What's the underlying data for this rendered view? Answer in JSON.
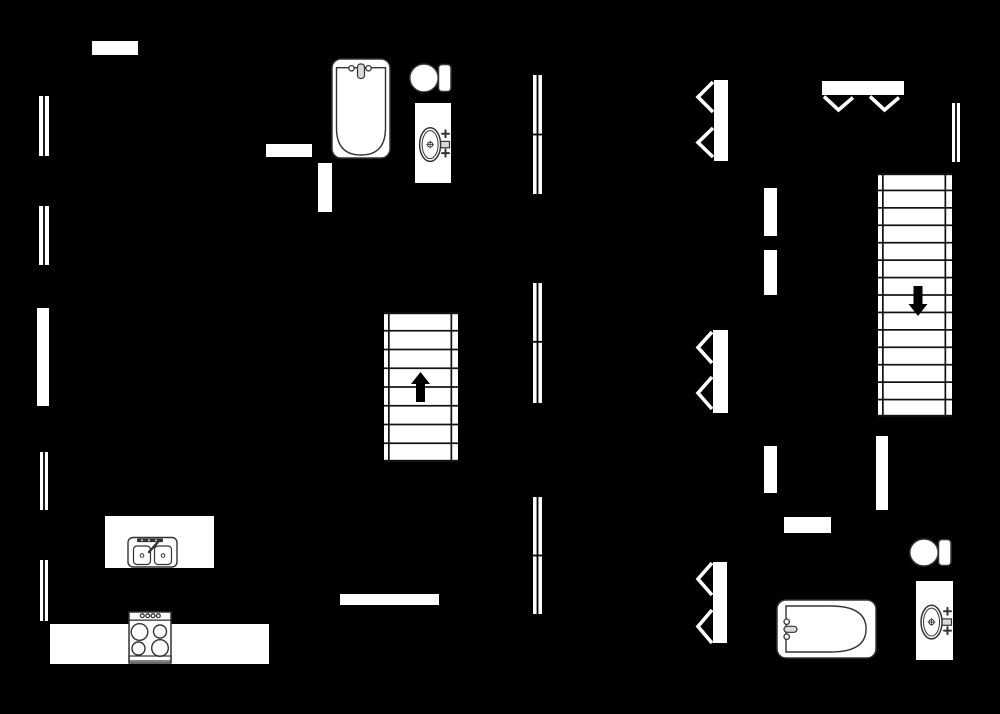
{
  "meta": {
    "diagram_type": "floor-plan",
    "canvas": {
      "width": 1000,
      "height": 714
    },
    "colors": {
      "background": "#000000",
      "walls": "#ffffff",
      "fixture_outline": "#333333",
      "fixture_metal": "#d9d9d9",
      "stair_lines": "#111111",
      "arrow": "#000000"
    }
  },
  "elements": [
    {
      "t": "wall",
      "name": "wall-top-left",
      "x": 92,
      "y": 41,
      "w": 46,
      "h": 14
    },
    {
      "t": "wall",
      "name": "wall-left-middle",
      "x": 37,
      "y": 308,
      "w": 12,
      "h": 98
    },
    {
      "t": "wall",
      "name": "wall-kitchen-horizontal",
      "x": 266,
      "y": 144,
      "w": 46,
      "h": 13
    },
    {
      "t": "wall",
      "name": "wall-kitchen-vertical",
      "x": 318,
      "y": 163,
      "w": 14,
      "h": 49
    },
    {
      "t": "wall",
      "name": "wall-hall-upper-a",
      "x": 764,
      "y": 188,
      "w": 13,
      "h": 48
    },
    {
      "t": "wall",
      "name": "wall-hall-upper-b",
      "x": 764,
      "y": 250,
      "w": 13,
      "h": 45
    },
    {
      "t": "wall",
      "name": "wall-hall-lower",
      "x": 764,
      "y": 446,
      "w": 13,
      "h": 47
    },
    {
      "t": "wall",
      "name": "wall-stair-lower",
      "x": 876,
      "y": 436,
      "w": 12,
      "h": 74
    },
    {
      "t": "wall",
      "name": "wall-bath-lower",
      "x": 784,
      "y": 517,
      "w": 47,
      "h": 16
    },
    {
      "t": "wall",
      "name": "wall-bottom-middle",
      "x": 340,
      "y": 594,
      "w": 99,
      "h": 11
    },
    {
      "t": "counter",
      "name": "kitchen-counter",
      "x": 50,
      "y": 624,
      "w": 219,
      "h": 40
    },
    {
      "t": "island",
      "name": "kitchen-island",
      "x": 105,
      "y": 516,
      "w": 109,
      "h": 52
    },
    {
      "t": "window",
      "name": "window-left-1",
      "x": 39,
      "y": 96,
      "w": 10,
      "h": 60,
      "dividers": []
    },
    {
      "t": "window",
      "name": "window-left-2",
      "x": 39,
      "y": 206,
      "w": 10,
      "h": 59,
      "dividers": []
    },
    {
      "t": "window",
      "name": "window-left-3",
      "x": 40,
      "y": 452,
      "w": 8,
      "h": 58,
      "dividers": []
    },
    {
      "t": "window",
      "name": "window-left-4",
      "x": 40,
      "y": 560,
      "w": 8,
      "h": 61,
      "dividers": []
    },
    {
      "t": "window",
      "name": "window-middle-1",
      "x": 533,
      "y": 75,
      "w": 9,
      "h": 119,
      "dividers": [
        0.5
      ]
    },
    {
      "t": "window",
      "name": "window-middle-2",
      "x": 533,
      "y": 283,
      "w": 9,
      "h": 120,
      "dividers": [
        0.49
      ]
    },
    {
      "t": "window",
      "name": "window-middle-3",
      "x": 533,
      "y": 497,
      "w": 9,
      "h": 117,
      "dividers": [
        0.5
      ]
    },
    {
      "t": "window",
      "name": "window-right",
      "x": 952,
      "y": 103,
      "w": 8,
      "h": 59,
      "dividers": []
    },
    {
      "t": "stairs",
      "name": "stairs-up",
      "x": 384,
      "y": 312,
      "w": 74,
      "h": 150,
      "treads": 7,
      "arrow": {
        "dir": "up",
        "cx": 420.5,
        "yTop": 372,
        "yBot": 402
      }
    },
    {
      "t": "stairs",
      "name": "stairs-down",
      "x": 878,
      "y": 173,
      "w": 74,
      "h": 244,
      "treads": 13,
      "arrow": {
        "dir": "down",
        "cx": 918,
        "yTop": 286,
        "yBot": 316
      }
    },
    {
      "t": "bifold",
      "name": "bifold-door-upper",
      "bar": {
        "x": 714,
        "y": 80,
        "w": 14,
        "h": 81
      },
      "tipX": 698,
      "chevrons": [
        [
          82,
          112
        ],
        [
          128,
          157
        ]
      ]
    },
    {
      "t": "bifold",
      "name": "bifold-door-middle",
      "bar": {
        "x": 713,
        "y": 330,
        "w": 15,
        "h": 83
      },
      "tipX": 698,
      "chevrons": [
        [
          332,
          363
        ],
        [
          377,
          409
        ]
      ]
    },
    {
      "t": "bifold",
      "name": "bifold-door-lower",
      "bar": {
        "x": 713,
        "y": 562,
        "w": 14,
        "h": 81
      },
      "tipX": 698,
      "chevrons": [
        [
          563,
          595
        ],
        [
          610,
          643
        ]
      ]
    },
    {
      "t": "double-door",
      "name": "double-door-entry",
      "bar": {
        "x": 822,
        "y": 81,
        "w": 82,
        "h": 14
      },
      "veeTop": 96.5,
      "veeTipY": 110,
      "vees": [
        [
          824,
          853
        ],
        [
          870,
          899
        ]
      ]
    },
    {
      "t": "bathtub-v",
      "name": "bathtub-upper",
      "x": 332,
      "y": 59,
      "w": 58,
      "h": 99
    },
    {
      "t": "toilet",
      "name": "toilet-upper",
      "x": 410,
      "y": 64,
      "w": 41,
      "h": 28
    },
    {
      "t": "vanity",
      "name": "sink-vanity-upper",
      "x": 415,
      "y": 103,
      "w": 36,
      "h": 80
    },
    {
      "t": "bathtub-h",
      "name": "bathtub-lower",
      "x": 777,
      "y": 600,
      "w": 99,
      "h": 58
    },
    {
      "t": "toilet",
      "name": "toilet-lower",
      "x": 910,
      "y": 539,
      "w": 41,
      "h": 27
    },
    {
      "t": "vanity",
      "name": "sink-vanity-lower",
      "x": 916,
      "y": 581,
      "w": 37,
      "h": 79
    },
    {
      "t": "stove",
      "name": "stove",
      "x": 129,
      "y": 612,
      "w": 42,
      "h": 51
    }
  ]
}
